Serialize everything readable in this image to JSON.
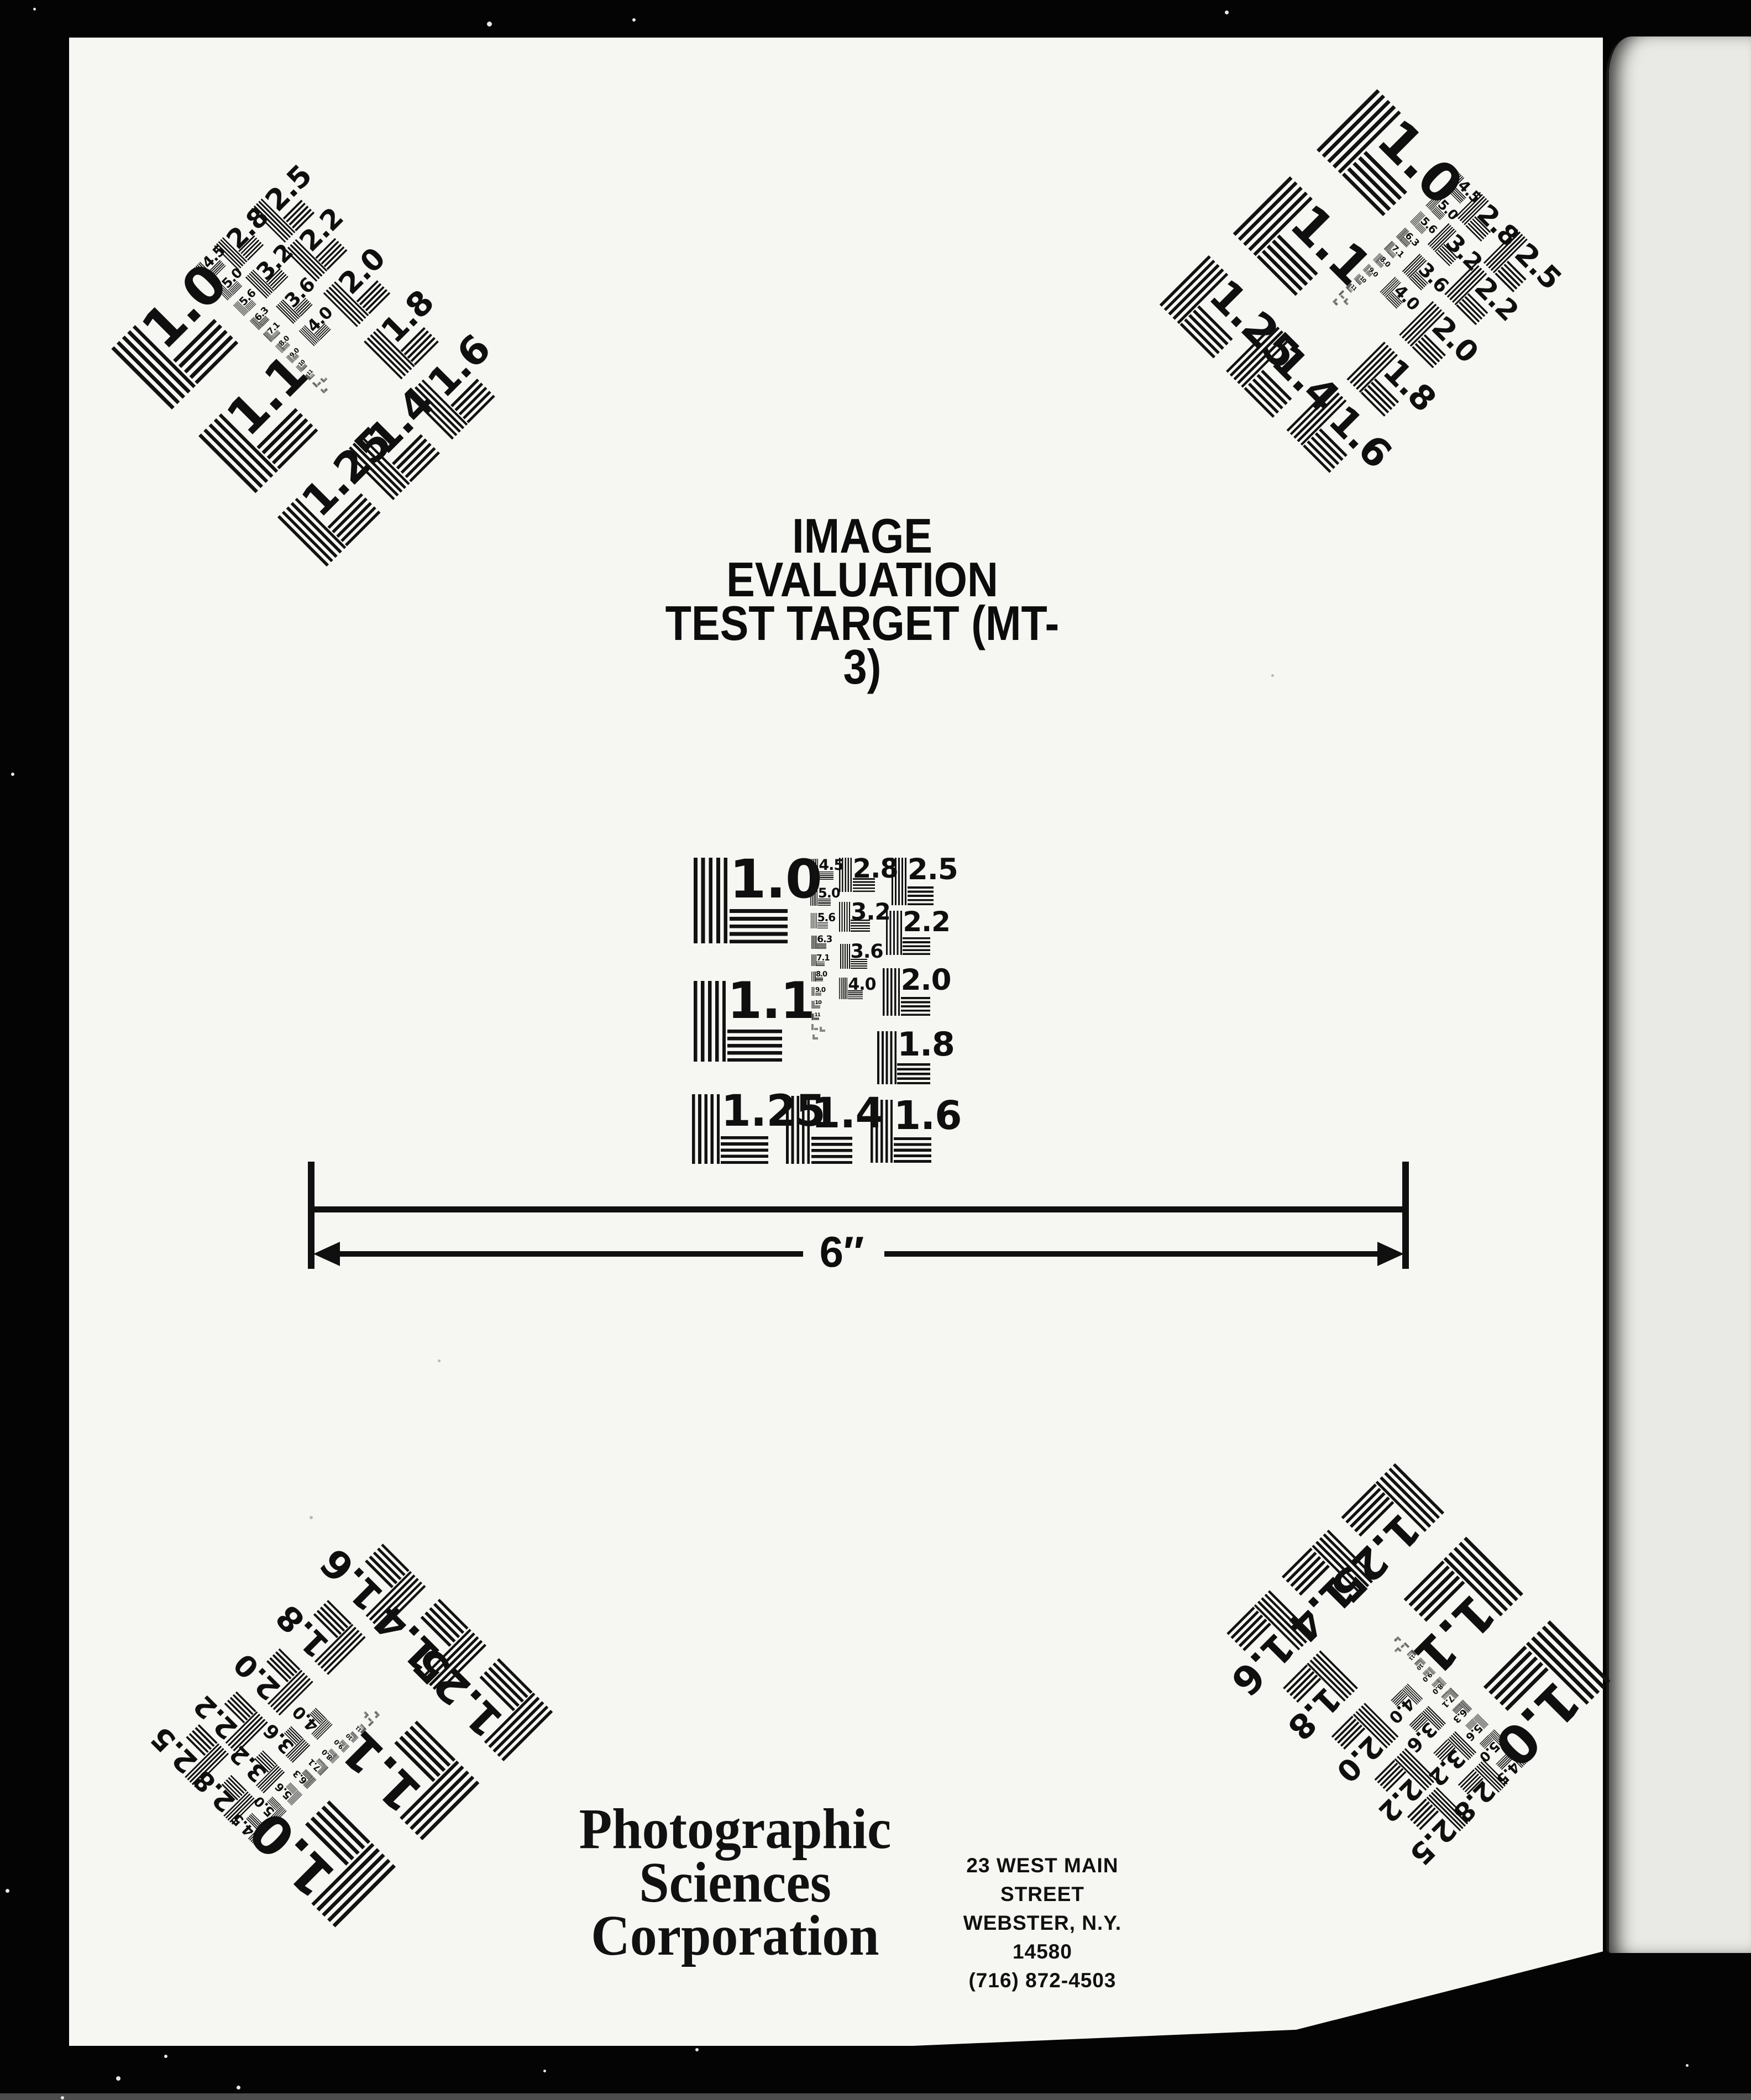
{
  "document": {
    "title_line1": "IMAGE EVALUATION",
    "title_line2": "TEST TARGET (MT-3)",
    "ruler": {
      "label": "6″"
    },
    "footer": {
      "company_lines": [
        "Photographic",
        "Sciences",
        "Corporation"
      ],
      "address_lines": [
        "23 WEST MAIN STREET",
        "WEBSTER, N.Y. 14580",
        "(716) 872-4503"
      ]
    },
    "test_pattern": {
      "large_labels": [
        "1.0",
        "1.1",
        "1.25",
        "1.4",
        "1.6",
        "1.8",
        "2.0",
        "2.2",
        "2.5"
      ],
      "small_labels": [
        "2.8",
        "3.2",
        "3.6",
        "4.0"
      ],
      "micro_labels": [
        "4.5",
        "5.0",
        "5.6",
        "6.3",
        "7.1",
        "8.0",
        "9.0",
        "10",
        "11"
      ]
    }
  }
}
